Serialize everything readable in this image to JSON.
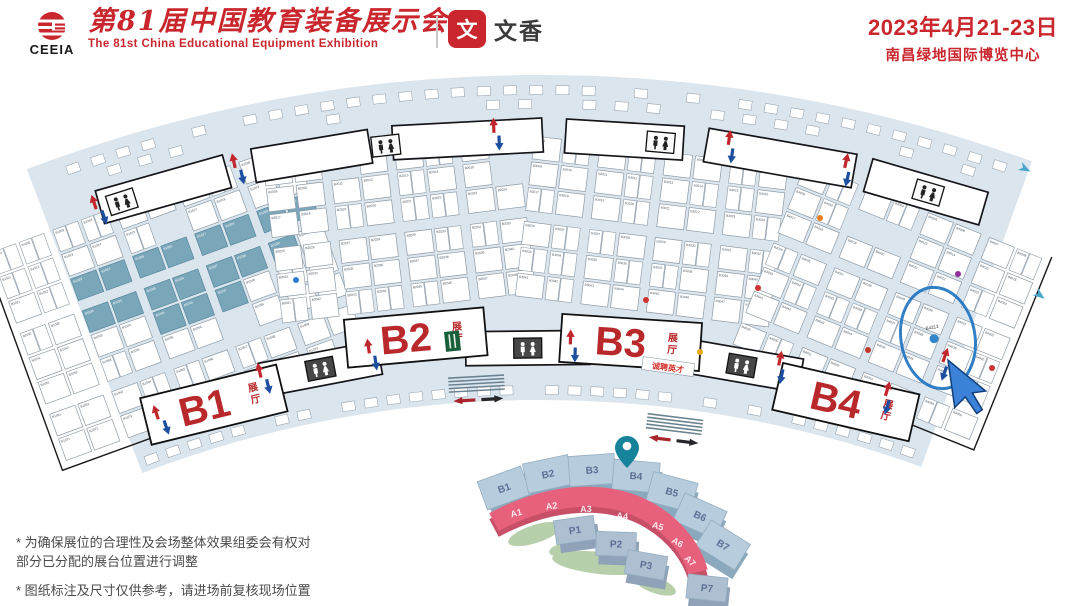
{
  "header": {
    "logo_acronym": "CEEIA",
    "title_cn": "第81届中国教育装备展示会",
    "title_en": "The 81st China Educational Equipment Exhibition",
    "partner_logo_char": "文",
    "partner_name": "文香",
    "date_range": "2023年4月21-23日",
    "venue": "南昌绿地国际博览中心",
    "accent_color": "#c9262d"
  },
  "map": {
    "band_color": "#dbe5ee",
    "booth_fill": "#ffffff",
    "booth_stroke": "#8d9aa6",
    "highlight_color": "#7aa6ba",
    "hall_label_color": "#b9292b",
    "hall_sublabel": "展厅",
    "halls": [
      {
        "label": "B1",
        "prefix": "B1",
        "tx": 180,
        "ty": 252,
        "rot": -20,
        "cols": 10,
        "rows": 8,
        "labelAngle": -16.3,
        "labelRadius": 1162
      },
      {
        "label": "B2",
        "prefix": "B2",
        "tx": 400,
        "ty": 178,
        "rot": -7,
        "cols": 8,
        "rows": 6,
        "labelAngle": -6.0,
        "labelRadius": 1189
      },
      {
        "label": "B3",
        "prefix": "B3",
        "tx": 652,
        "ty": 182,
        "rot": 7,
        "cols": 8,
        "rows": 6,
        "labelAngle": 4.4,
        "labelRadius": 1181
      },
      {
        "label": "B4",
        "prefix": "B4",
        "tx": 888,
        "ty": 252,
        "rot": 22,
        "cols": 8,
        "rows": 7,
        "labelAngle": 15.3,
        "labelRadius": 1159
      }
    ],
    "annotations": {
      "circled_booth_code": "B4213",
      "recruit_text": "诚聘英才"
    }
  },
  "minimap": {
    "blocks": [
      "B1",
      "B2",
      "B3",
      "B4",
      "B5",
      "B6",
      "B7"
    ],
    "arc_labels": [
      "A1",
      "A2",
      "A3",
      "A4",
      "A5",
      "A6",
      "A7"
    ],
    "parking": [
      "P1",
      "P2",
      "P3",
      "P7"
    ],
    "pin_over_block": "B4",
    "block_color": "#b7cdde",
    "arc_color": "#e8617c",
    "pin_color": "#17839a"
  },
  "footnotes": [
    "* 为确保展位的合理性及会场整体效果组委会有权对",
    "部分已分配的展台位置进行调整",
    "* 图纸标注及尺寸仅供参考，请进场前复核现场位置"
  ]
}
